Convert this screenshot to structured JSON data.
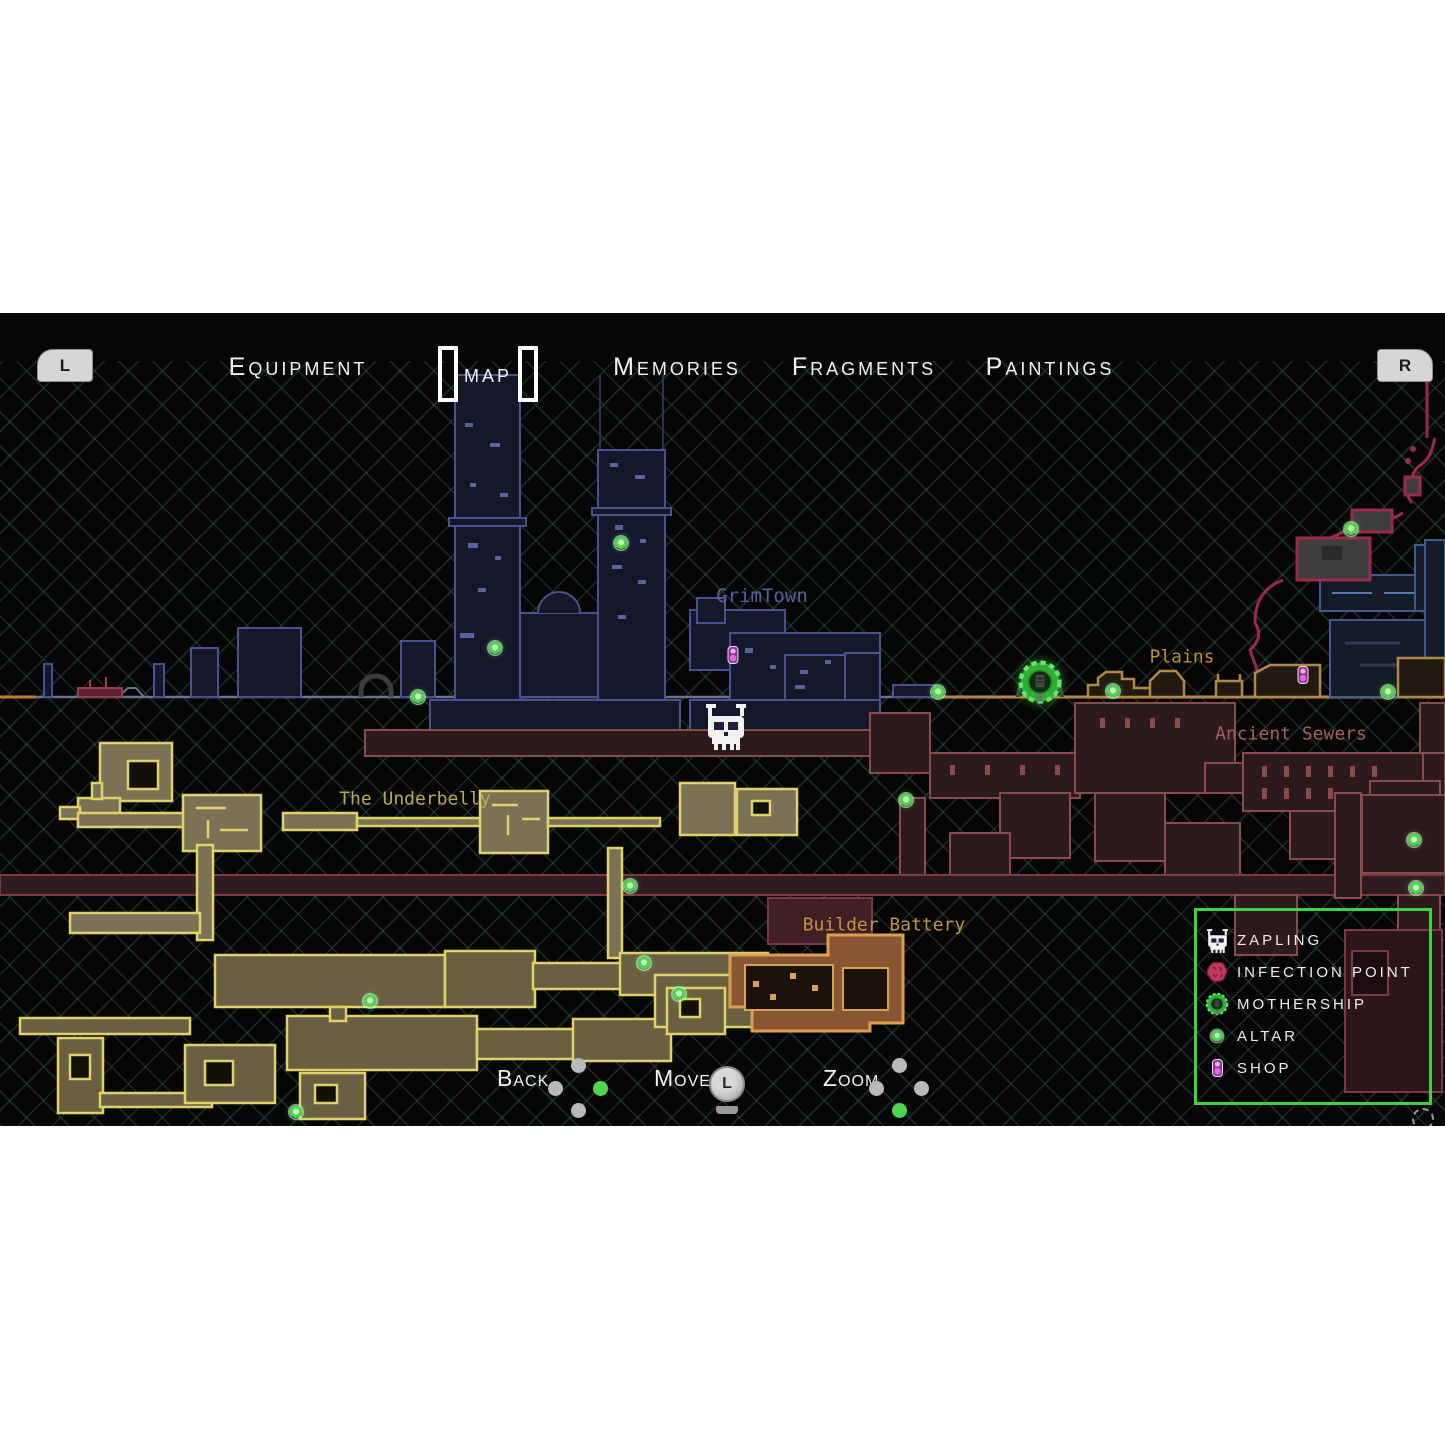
{
  "nav": {
    "left_bumper": "L",
    "right_bumper": "R",
    "tabs": [
      {
        "label": "Equipment",
        "selected": false
      },
      {
        "label": "Map",
        "selected": true
      },
      {
        "label": "Memories",
        "selected": false
      },
      {
        "label": "Fragments",
        "selected": false
      },
      {
        "label": "Paintings",
        "selected": false
      }
    ]
  },
  "map": {
    "area_labels": [
      {
        "name": "GrimTown",
        "color": "#575d9e"
      },
      {
        "name": "Plains",
        "color": "#c08a3e"
      },
      {
        "name": "Ancient Sewers",
        "color": "#a85f5f"
      },
      {
        "name": "The Underbelly",
        "color": "#b5aa55"
      },
      {
        "name": "Builder Battery",
        "color": "#c8933c"
      }
    ],
    "region_colors": {
      "city_outline": "#4b5090",
      "sewer_outline": "#8a4a4e",
      "vine": "#9c2a4a",
      "plains_outline": "#b08948",
      "underbelly_outline": "#ded36b",
      "battery_outline": "#d8a050"
    },
    "markers": {
      "player": {
        "type": "zapling",
        "x": 726,
        "y": 413
      },
      "mothership": {
        "x": 1040,
        "y": 369
      },
      "altars": [
        [
          418,
          384
        ],
        [
          495,
          335
        ],
        [
          621,
          230
        ],
        [
          938,
          379
        ],
        [
          1113,
          378
        ],
        [
          1388,
          379
        ],
        [
          1351,
          216
        ],
        [
          906,
          487
        ],
        [
          630,
          573
        ],
        [
          1414,
          527
        ],
        [
          1416,
          575
        ],
        [
          370,
          688
        ],
        [
          644,
          650
        ],
        [
          679,
          681
        ],
        [
          296,
          799
        ]
      ],
      "shops": [
        [
          733,
          342
        ],
        [
          1303,
          362
        ]
      ]
    }
  },
  "legend": {
    "border_color": "#3fd23f",
    "items": [
      {
        "icon": "zapling-icon",
        "label": "ZAPLING"
      },
      {
        "icon": "infection-point-icon",
        "label": "INFECTION POINT"
      },
      {
        "icon": "mothership-icon",
        "label": "MOTHERSHIP"
      },
      {
        "icon": "altar-icon",
        "label": "ALTAR"
      },
      {
        "icon": "shop-icon",
        "label": "SHOP"
      }
    ]
  },
  "controls": [
    {
      "label": "Back",
      "input": "dpad",
      "active_direction": "right"
    },
    {
      "label": "Move",
      "input": "left-stick",
      "stick_letter": "L"
    },
    {
      "label": "Zoom",
      "input": "dpad",
      "active_direction": "down"
    }
  ],
  "status": {
    "autosave_icon": "autosave-spinner"
  }
}
